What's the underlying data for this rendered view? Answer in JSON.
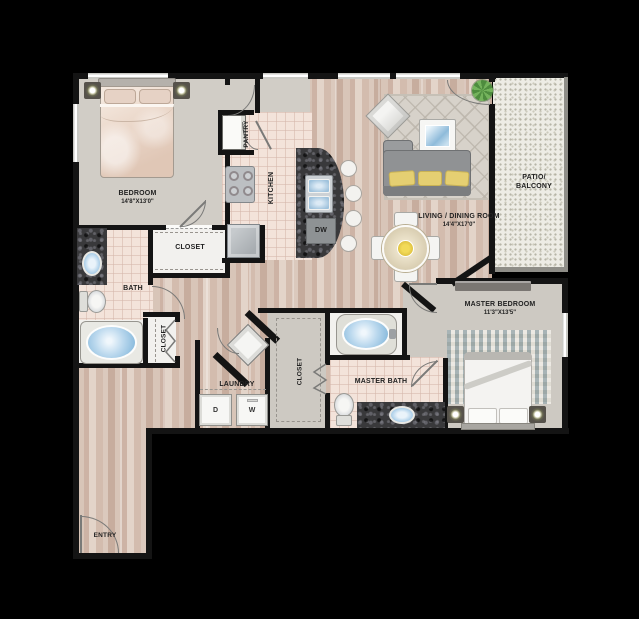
{
  "floorplan": {
    "rooms": {
      "bedroom": {
        "name": "BEDROOM",
        "dims": "14'8\"X13'0\""
      },
      "living_dining": {
        "name": "LIVING / DINING ROOM",
        "dims": "14'4\"X17'0\""
      },
      "master_bedroom": {
        "name": "MASTER BEDROOM",
        "dims": "11'3\"X13'5\""
      },
      "kitchen": {
        "name": "KITCHEN"
      },
      "pantry": {
        "name": "PANTRY"
      },
      "bath": {
        "name": "BATH"
      },
      "master_bath": {
        "name": "MASTER BATH"
      },
      "laundry": {
        "name": "LAUNDRY"
      },
      "entry": {
        "name": "ENTRY"
      },
      "patio": {
        "name": "PATIO/ BALCONY"
      },
      "closet_bedroom": {
        "name": "CLOSET"
      },
      "closet_hall": {
        "name": "CLOSET"
      },
      "closet_master": {
        "name": "CLOSET"
      }
    },
    "appliances": {
      "dishwasher": "DW",
      "dryer": "D",
      "washer": "W"
    },
    "colors": {
      "wall": "#141414",
      "wood_floor": "#d5c1b3",
      "carpet": "#d1cdc6",
      "tile": "#f3e3da",
      "granite": "#39393b",
      "patio": "#edece5",
      "pillow_accent": "#e5cf72",
      "tub_water": "#9cc6e4",
      "plant": "#4e8c3e"
    }
  }
}
